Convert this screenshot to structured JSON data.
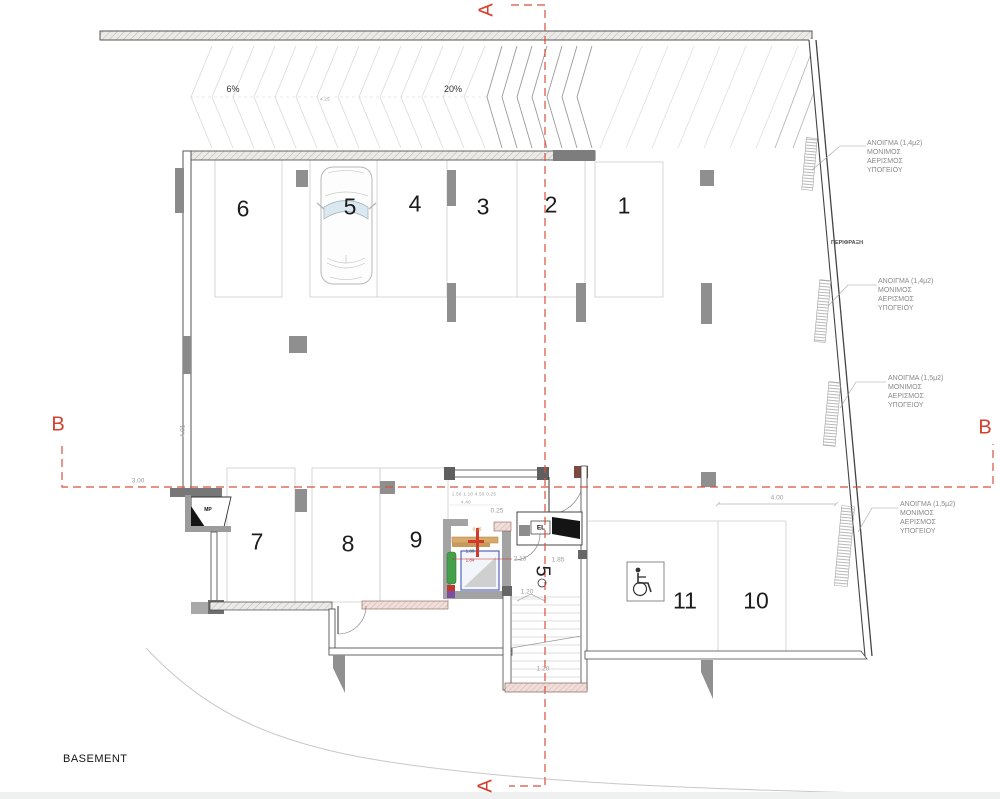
{
  "floor_label": "BASEMENT",
  "sections": {
    "a_top": "A",
    "a_bottom": "A",
    "b_left": "B",
    "b_right": "B"
  },
  "ramp": {
    "slope_gentle": "6%",
    "slope_steep": "20%",
    "length": "4.25"
  },
  "parking": {
    "numbers": [
      "1",
      "2",
      "3",
      "4",
      "5",
      "6",
      "7",
      "8",
      "9",
      "10",
      "11"
    ]
  },
  "core": {
    "elevator_label": "EL",
    "utility_label": "MP",
    "stair_tag": "5"
  },
  "dims": {
    "aisle": "3.00",
    "left_wall": "4.01",
    "bay10_width": "4.00",
    "lobby_a": "2.13",
    "lobby_b": "1.85",
    "stair_top": "1.20",
    "stair_bottom": "1.20",
    "mech_top": "0.25",
    "mech_offset": "0.25",
    "mech_a": "1.80",
    "mech_b": "1.84",
    "tiny_row1": "1.50  1.10  4.50  0.25",
    "tiny_row2": "4.40"
  },
  "annotations": {
    "fence": "ΠΕΡΙΦΡΑΞΗ",
    "vent1": {
      "l1": "ΑΝΟΙΓΜΑ (1,4μ2)",
      "l2": "ΜΟΝΙΜΟΣ",
      "l3": "ΑΕΡΙΣΜΟΣ",
      "l4": "ΥΠΟΓΕΙΟΥ"
    },
    "vent2": {
      "l1": "ΑΝΟΙΓΜΑ (1,4μ2)",
      "l2": "ΜΟΝΙΜΟΣ",
      "l3": "ΑΕΡΙΣΜΟΣ",
      "l4": "ΥΠΟΓΕΙΟΥ"
    },
    "vent3": {
      "l1": "ΑΝΟΙΓΜΑ (1,5μ2)",
      "l2": "ΜΟΝΙΜΟΣ",
      "l3": "ΑΕΡΙΣΜΟΣ",
      "l4": "ΥΠΟΓΕΙΟΥ"
    },
    "vent4": {
      "l1": "ΑΝΟΙΓΜΑ (1,5μ2)",
      "l2": "ΜΟΝΙΜΟΣ",
      "l3": "ΑΕΡΙΣΜΟΣ",
      "l4": "ΥΠΟΓΕΙΟΥ"
    }
  },
  "colors": {
    "section_red": "#d6402e",
    "wall": "#4a4a4a",
    "column": "#8f8f8f"
  }
}
